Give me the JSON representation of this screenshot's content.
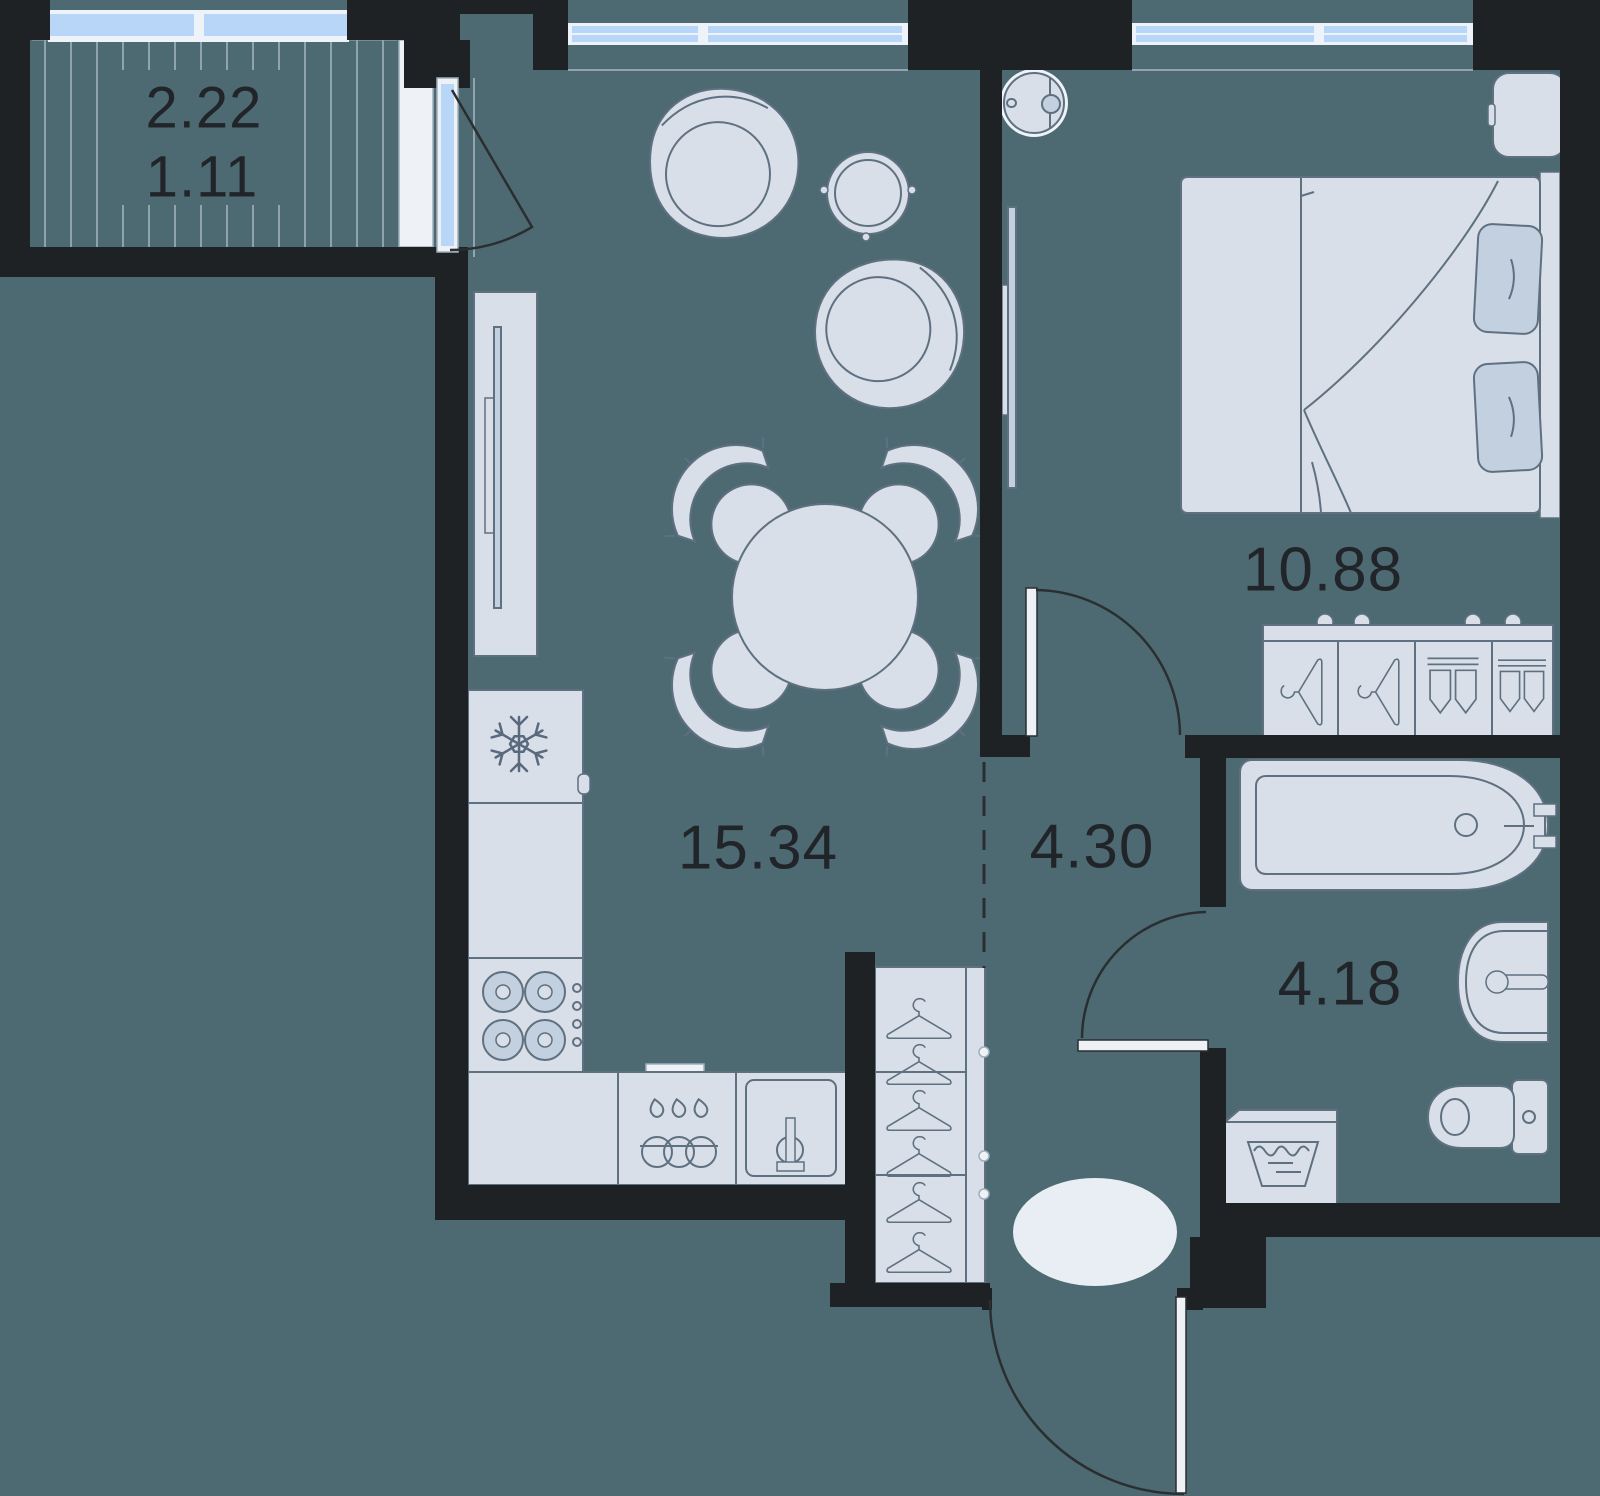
{
  "rooms": {
    "balcony": {
      "area_total": "2.22",
      "area_reduced": "1.11"
    },
    "living_kitchen": {
      "area": "15.34"
    },
    "hallway": {
      "area": "4.30"
    },
    "bedroom": {
      "area": "10.88"
    },
    "bathroom": {
      "area": "4.18"
    }
  },
  "colors": {
    "floor": "#4d6a73",
    "wall": "#1f2225",
    "furniture-fill": "#d8dfe9",
    "furniture-accent": "#c3d0df",
    "furniture-stroke": "#5f7080",
    "icon-stroke": "#5a6a7c",
    "window-glass": "#b8d6f8",
    "window-frame": "#eef3f9",
    "door-line": "#2b2e31",
    "light-surface": "#eef2f6",
    "rug": "#e9edf4",
    "hatch-line": "#8fa3ad",
    "label-text": "#212529"
  },
  "fixtures": [
    "balcony-glazing",
    "balcony-door",
    "living-room-window",
    "bedroom-window",
    "armchair",
    "side-table",
    "dining-table",
    "dining-chair",
    "tv-console",
    "tv",
    "fridge",
    "snowflake-icon",
    "stove",
    "dishwasher",
    "kitchen-sink",
    "wardrobe",
    "hanger-icon",
    "doormat-rug",
    "entrance-door",
    "bedroom-door",
    "bathroom-door",
    "bed",
    "pillow",
    "nightstand",
    "ceiling-light",
    "dresser",
    "folded-clothes-icon",
    "bathtub",
    "washbasin",
    "toilet",
    "washing-machine"
  ]
}
